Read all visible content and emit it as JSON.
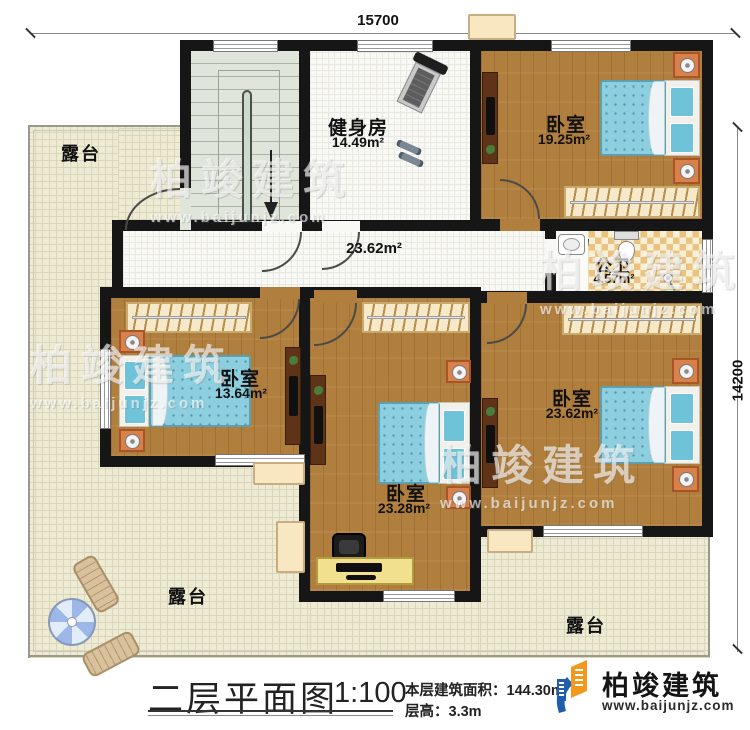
{
  "dimensions": {
    "top": "15700",
    "right": "14200"
  },
  "rooms": {
    "gym": {
      "name": "健身房",
      "area": "14.49m²"
    },
    "bedroom_top_right": {
      "name": "卧室",
      "area": "19.25m²"
    },
    "bathroom": {
      "name": "公卫",
      "area": "4.57m²"
    },
    "hallway": {
      "area": "23.62m²"
    },
    "bedroom_left": {
      "name": "卧室",
      "area": "13.64m²"
    },
    "bedroom_middle": {
      "name": "卧室",
      "area": "23.28m²"
    },
    "bedroom_bottom_right": {
      "name": "卧室",
      "area": "23.62m²"
    },
    "terrace_top_left": {
      "name": "露台"
    },
    "terrace_bottom_left": {
      "name": "露台"
    },
    "terrace_bottom_right": {
      "name": "露台"
    }
  },
  "footer": {
    "title": "二层平面图",
    "scale": "1:100",
    "floor_area": "本层建筑面积：144.30m²",
    "floor_height": "层高：3.3m",
    "brand": "柏竣建筑",
    "website": "www.baijunjz.com"
  },
  "watermark": {
    "text": "柏竣建筑",
    "url": "www.baijunjz.com"
  },
  "colors": {
    "brand_blue": "#1d5fae",
    "brand_orange": "#f2991d"
  }
}
